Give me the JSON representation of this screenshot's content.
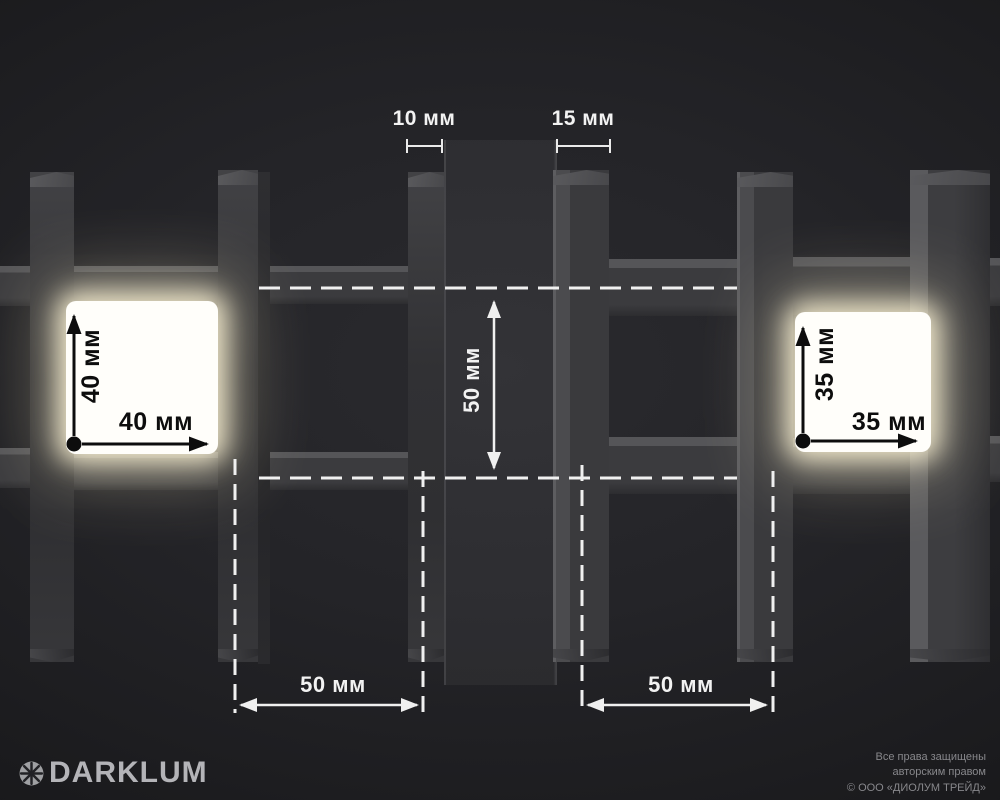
{
  "annotations": {
    "profile_left": "10 мм",
    "profile_right": "15 мм",
    "cell_left_height": "40 мм",
    "cell_left_width": "40 мм",
    "cell_right_height": "35 мм",
    "cell_right_width": "35 мм",
    "pitch_center": "50 мм",
    "pitch_bottom_left": "50 мм",
    "pitch_bottom_right": "50 мм"
  },
  "branding": {
    "logo": "DARKLUM"
  },
  "footer": {
    "line1": "Все права защищены",
    "line2": "авторским правом",
    "line3": "© ООО «ДИОЛУМ ТРЕЙД»"
  },
  "colors": {
    "background": "#1d1d20",
    "metal_dark": "#353538",
    "glow_warm": "#fff6d7",
    "dimension_white": "#f2f2f2",
    "dimension_black": "#0d0d0d"
  }
}
